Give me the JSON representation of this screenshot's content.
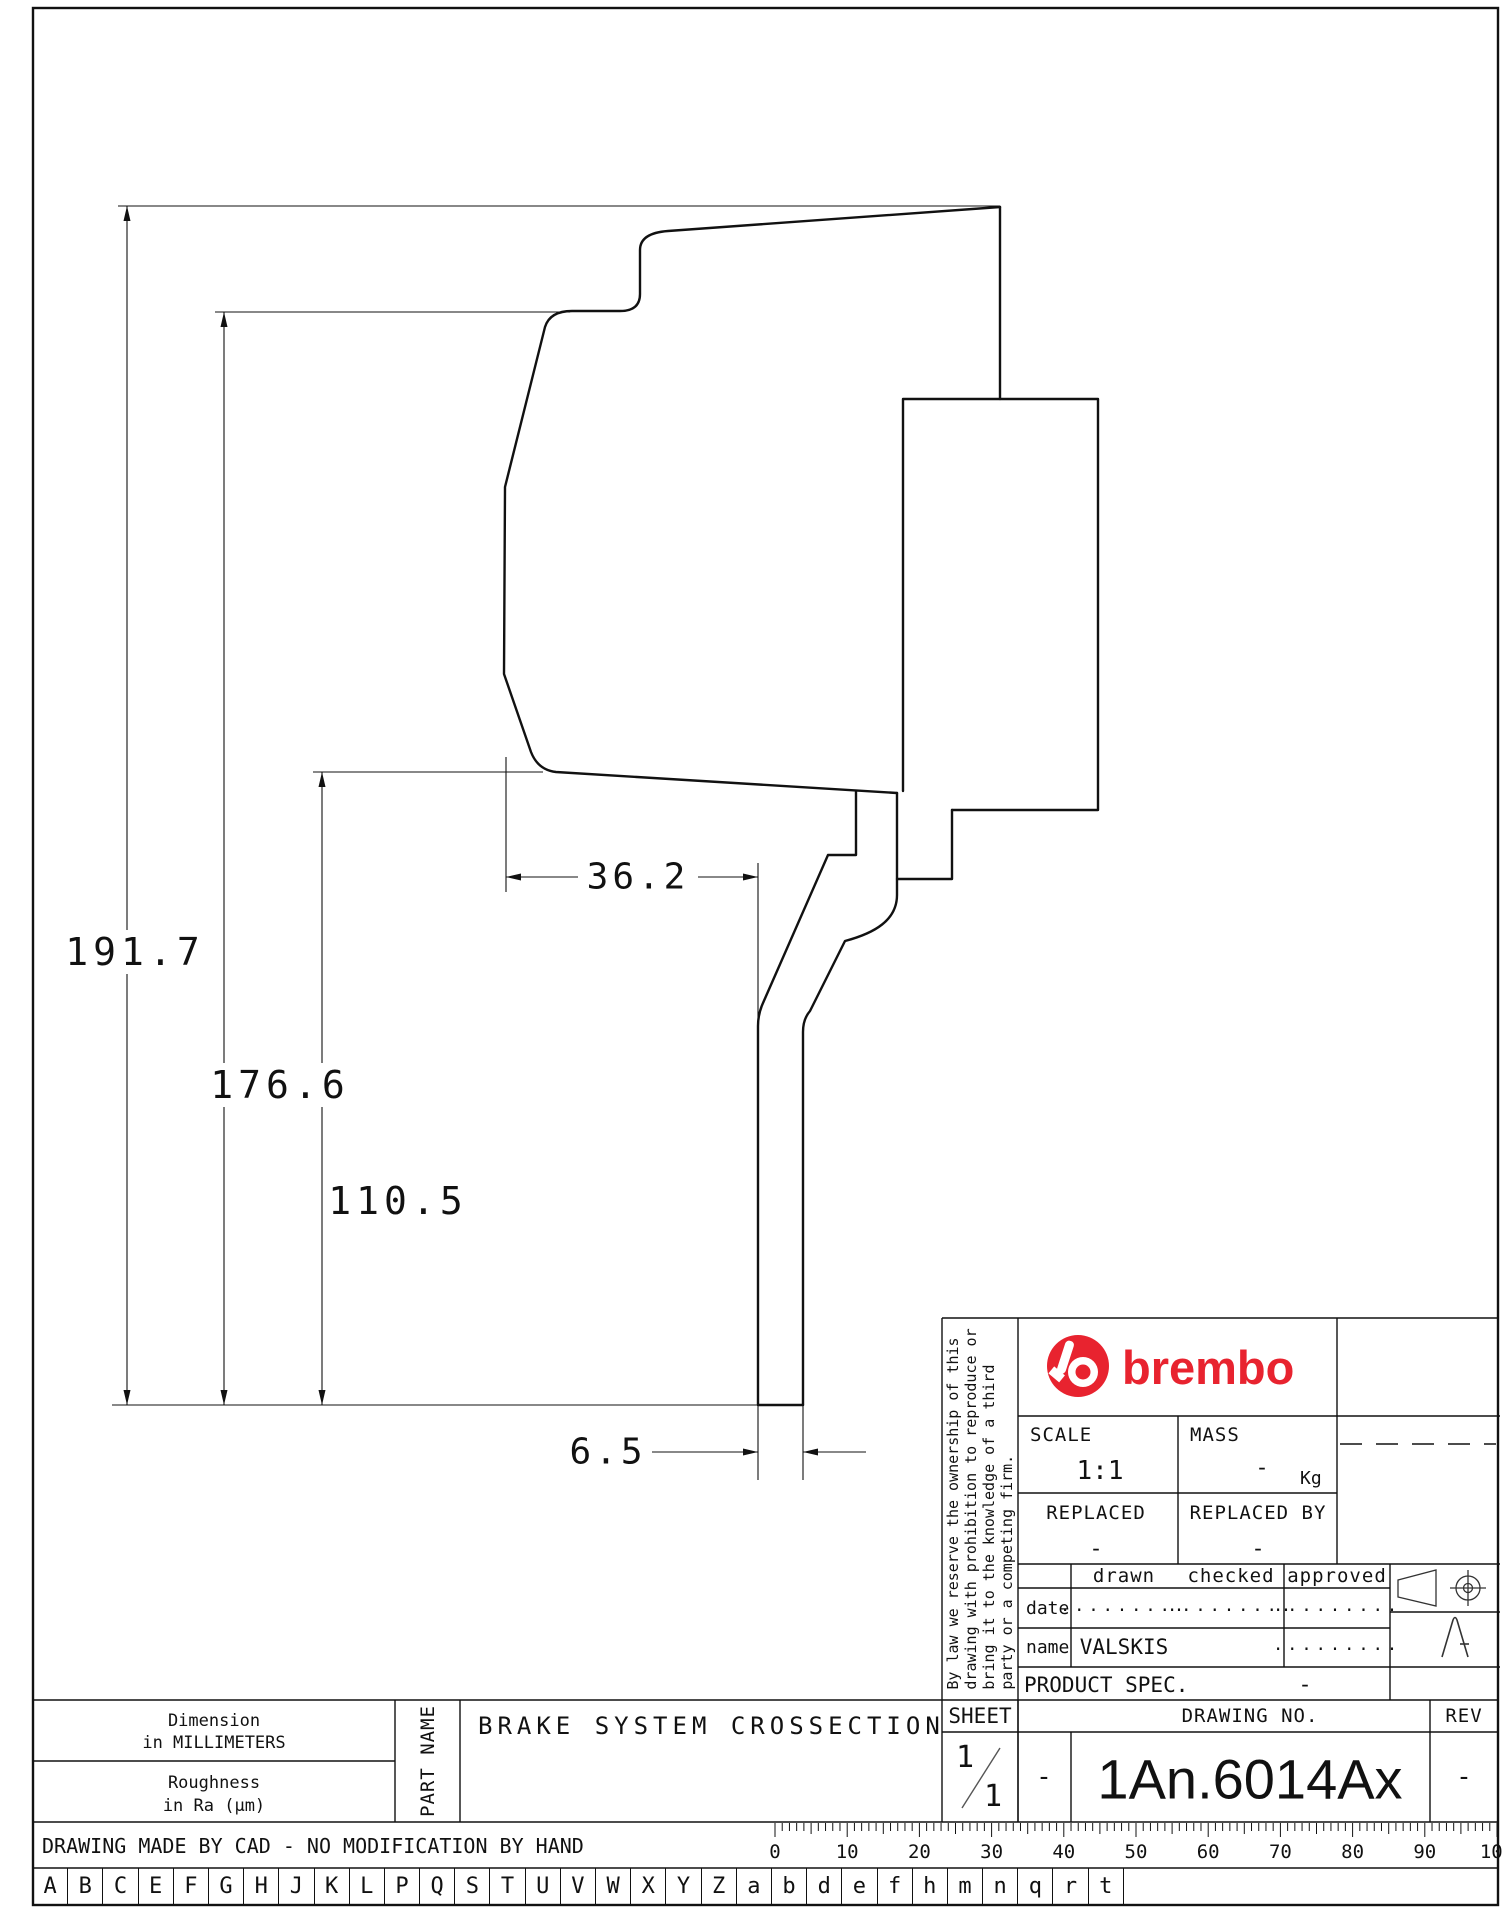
{
  "dimensions": {
    "height_overall": "191.7",
    "height_mid": "176.6",
    "height_inner": "110.5",
    "width_bell": "36.2",
    "shaft_thickness": "6.5"
  },
  "title_block": {
    "brand": "brembo",
    "scale_label": "SCALE",
    "scale_value": "1:1",
    "mass_label": "MASS",
    "mass_value": "-",
    "mass_unit": "Kg",
    "replaced_label": "REPLACED",
    "replaced_value": "-",
    "replaced_by_label": "REPLACED BY",
    "replaced_by_value": "-",
    "col_drawn": "drawn",
    "col_checked": "checked",
    "col_approved": "approved",
    "row_date": "date",
    "row_name": "name",
    "date_drawn": ".........",
    "date_checked": ".........",
    "date_approved": ".........",
    "name_drawn": "VALSKIS",
    "name_approved": ".........",
    "product_spec_label": "PRODUCT SPEC.",
    "product_spec_value": "-",
    "sheet_label": "SHEET",
    "sheet_num": "1",
    "sheet_den": "1",
    "sheet_dash": "-",
    "drawing_no_label": "DRAWING NO.",
    "drawing_no": "1An.6014Ax",
    "rev_label": "REV",
    "rev_value": "-",
    "legal_lines": [
      "By law we reserve the ownership of this",
      "drawing with prohibition to reproduce or",
      "bring it to the knowledge of a third",
      "party or a competing firm."
    ]
  },
  "footer": {
    "dim_note_1": "Dimension",
    "dim_note_2": "in MILLIMETERS",
    "rough_note_1": "Roughness",
    "rough_note_2": "in Ra (µm)",
    "part_name_label": "PART NAME",
    "part_title": "BRAKE SYSTEM CROSSECTION",
    "cad_note": "DRAWING MADE BY CAD - NO MODIFICATION BY HAND",
    "ruler_numbers": [
      0,
      10,
      20,
      30,
      40,
      50,
      60,
      70,
      80,
      90,
      100
    ],
    "letters": [
      "A",
      "B",
      "C",
      "E",
      "F",
      "G",
      "H",
      "J",
      "K",
      "L",
      "P",
      "Q",
      "S",
      "T",
      "U",
      "V",
      "W",
      "X",
      "Y",
      "Z",
      "a",
      "b",
      "d",
      "e",
      "f",
      "h",
      "m",
      "n",
      "q",
      "r",
      "t"
    ]
  },
  "colors": {
    "brand_red": "#e8232f",
    "line_black": "#111111"
  }
}
